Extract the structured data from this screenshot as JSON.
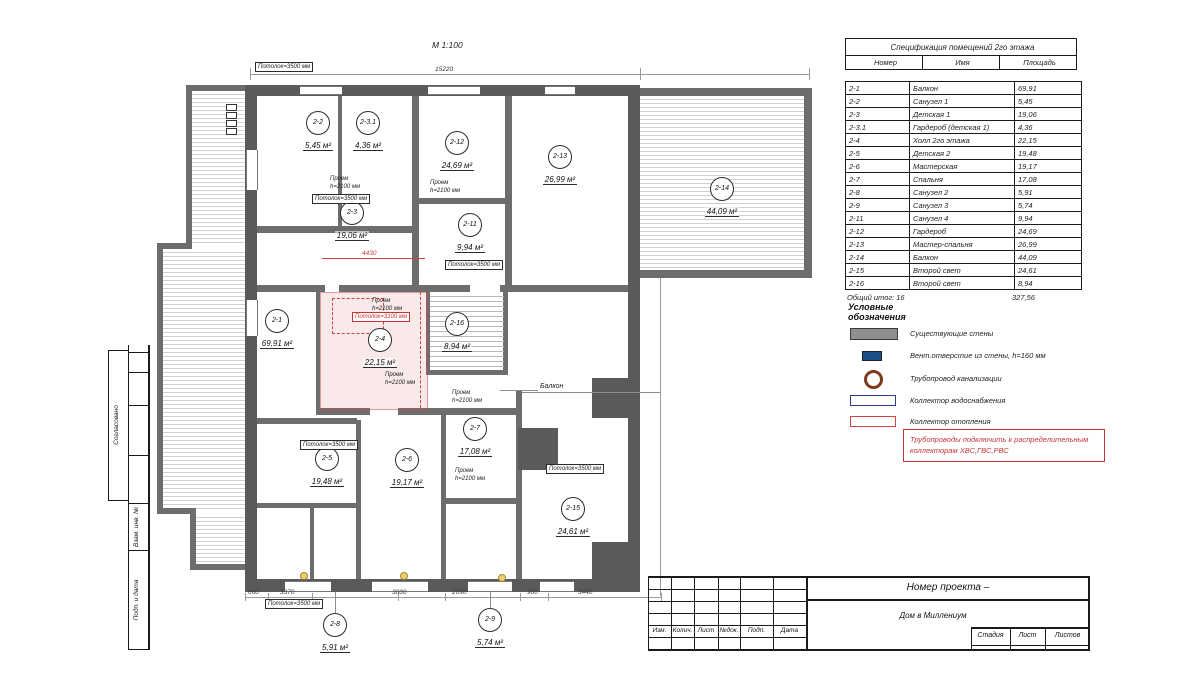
{
  "plan": {
    "scale": "М 1:100",
    "area_unit": "м²",
    "dim_top": "15220",
    "dim_red": "4430",
    "dims_bottom": [
      "660",
      "3370",
      "3000",
      "2090",
      "960",
      "3440"
    ],
    "balcony_label": "Балкон",
    "opening_line1": "Проем",
    "opening_line2": "h=2100 мм",
    "ceiling_note": "Потолок=3500 мм",
    "ceiling_note_red": "Потолок=3100 мм"
  },
  "rooms": [
    {
      "num": "2-1",
      "name": "Балкон",
      "area": "69,91"
    },
    {
      "num": "2-2",
      "name": "Санузел 1",
      "area": "5,45"
    },
    {
      "num": "2-3",
      "name": "Детская 1",
      "area": "19,06"
    },
    {
      "num": "2-3.1",
      "name": "Гардероб (детская 1)",
      "area": "4,36"
    },
    {
      "num": "2-4",
      "name": "Холл 2го этажа",
      "area": "22,15"
    },
    {
      "num": "2-5",
      "name": "Детская 2",
      "area": "19,48"
    },
    {
      "num": "2-6",
      "name": "Мастерская",
      "area": "19,17"
    },
    {
      "num": "2-7",
      "name": "Спальня",
      "area": "17,08"
    },
    {
      "num": "2-8",
      "name": "Санузел 2",
      "area": "5,91"
    },
    {
      "num": "2-9",
      "name": "Санузел 3",
      "area": "5,74"
    },
    {
      "num": "2-11",
      "name": "Санузел 4",
      "area": "9,94"
    },
    {
      "num": "2-12",
      "name": "Гардероб",
      "area": "24,69"
    },
    {
      "num": "2-13",
      "name": "Мастер-спальня",
      "area": "26,99"
    },
    {
      "num": "2-14",
      "name": "Балкон",
      "area": "44,09"
    },
    {
      "num": "2-15",
      "name": "Второй свет",
      "area": "24,61"
    },
    {
      "num": "2-16",
      "name": "Второй свет",
      "area": "8,94"
    }
  ],
  "spec_table": {
    "title": "Спецификация помещений 2го этажа",
    "col_num": "Номер",
    "col_name": "Имя",
    "col_area": "Площадь",
    "total_label": "Общий итог: 16",
    "total_value": "327,56"
  },
  "legend": {
    "title": "Условные обозначения",
    "items": [
      "Существующие стены",
      "Вент.отверстие из стены, h=160 мм",
      "Трубопровод канализации",
      "Коллектор водоснабжения",
      "Коллектор отопления"
    ],
    "note_line1": "Трубопроводы подключить к распределительным",
    "note_line2": "коллекторам ХВС,ГВС,РВС"
  },
  "title_block": {
    "project_label": "Номер проекта –",
    "project_name": "Дом в Миллениум",
    "rev_cols": [
      "Изм.",
      "Колич.",
      "Лист",
      "№док.",
      "Подп.",
      "Дата"
    ],
    "stage_cols": [
      "Стадия",
      "Лист",
      "Листов"
    ]
  },
  "side_strip": {
    "items": [
      "Согласовано",
      "Взам. инв. №",
      "Подп. и дата"
    ]
  }
}
